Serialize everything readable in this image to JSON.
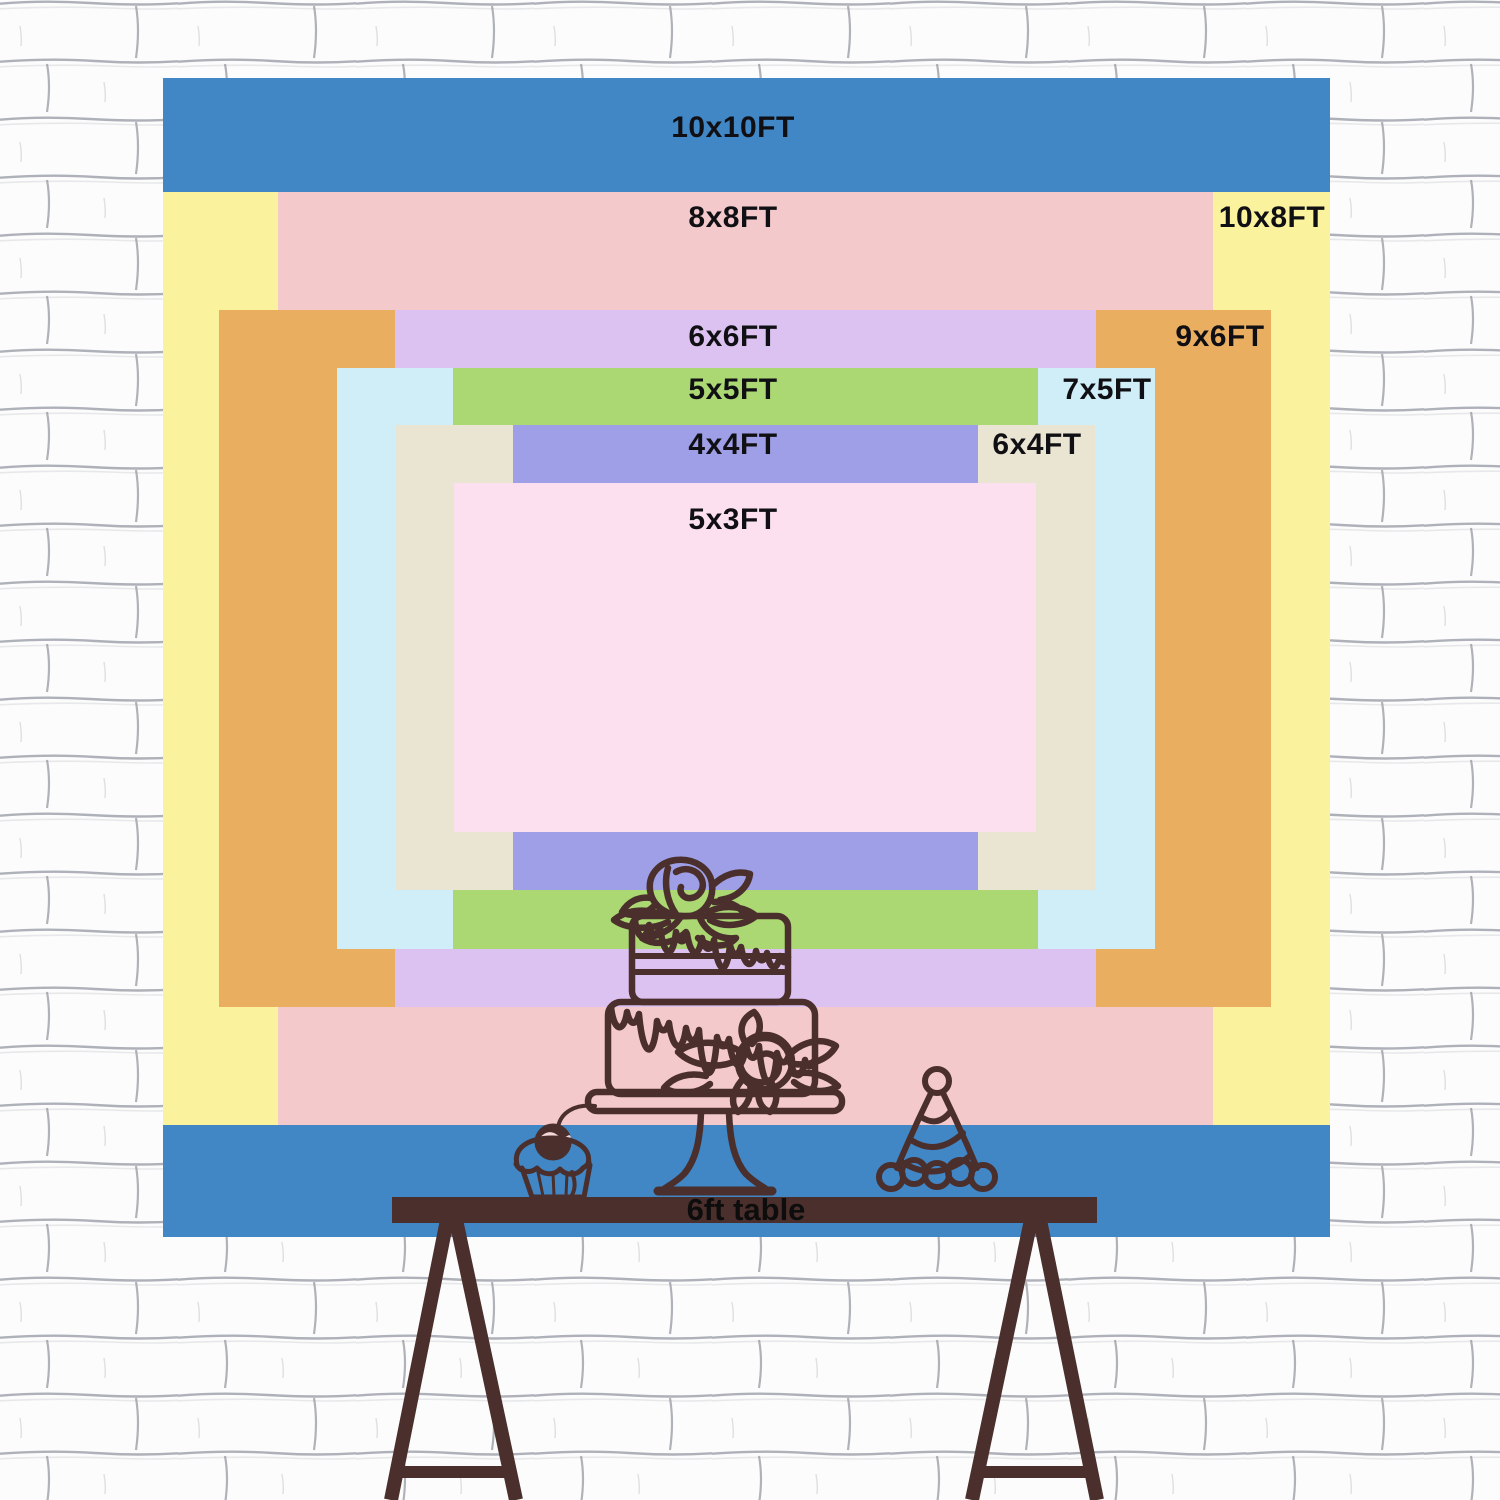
{
  "chart": {
    "unit": "FT",
    "layers": [
      {
        "id": "10x10",
        "label": "10x10FT",
        "width_ft": 10,
        "height_ft": 10,
        "color": "#4186c5"
      },
      {
        "id": "10x8",
        "label": "10x8FT",
        "width_ft": 10,
        "height_ft": 8,
        "color": "#fbf29d"
      },
      {
        "id": "8x8",
        "label": "8x8FT",
        "width_ft": 8,
        "height_ft": 8,
        "color": "#f4c9cb"
      },
      {
        "id": "9x6",
        "label": "9x6FT",
        "width_ft": 9,
        "height_ft": 6,
        "color": "#eaae61"
      },
      {
        "id": "6x6",
        "label": "6x6FT",
        "width_ft": 6,
        "height_ft": 6,
        "color": "#dcc2f1"
      },
      {
        "id": "7x5",
        "label": "7x5FT",
        "width_ft": 7,
        "height_ft": 5,
        "color": "#cfeef8"
      },
      {
        "id": "5x5",
        "label": "5x5FT",
        "width_ft": 5,
        "height_ft": 5,
        "color": "#abd873"
      },
      {
        "id": "6x4",
        "label": "6x4FT",
        "width_ft": 6,
        "height_ft": 4,
        "color": "#eae5d3"
      },
      {
        "id": "4x4",
        "label": "4x4FT",
        "width_ft": 4,
        "height_ft": 4,
        "color": "#9e9fe6"
      },
      {
        "id": "5x3",
        "label": "5x3FT",
        "width_ft": 5,
        "height_ft": 3,
        "color": "#fce0f0"
      }
    ],
    "label_color": "#101014"
  },
  "table": {
    "label": "6ft table",
    "bar_color": "#4a2f2c",
    "label_color": "#0d0d0d"
  },
  "decorations": {
    "stroke_color": "#4a2f2c",
    "cherry_highlight_color": "#f5d9da",
    "items": [
      "cake-icon",
      "cupcake-icon",
      "party-hat-icon",
      "trestle-legs"
    ]
  },
  "wall": {
    "brick_color": "#fcfcfc",
    "mortar_color": "#a0a4ad"
  }
}
